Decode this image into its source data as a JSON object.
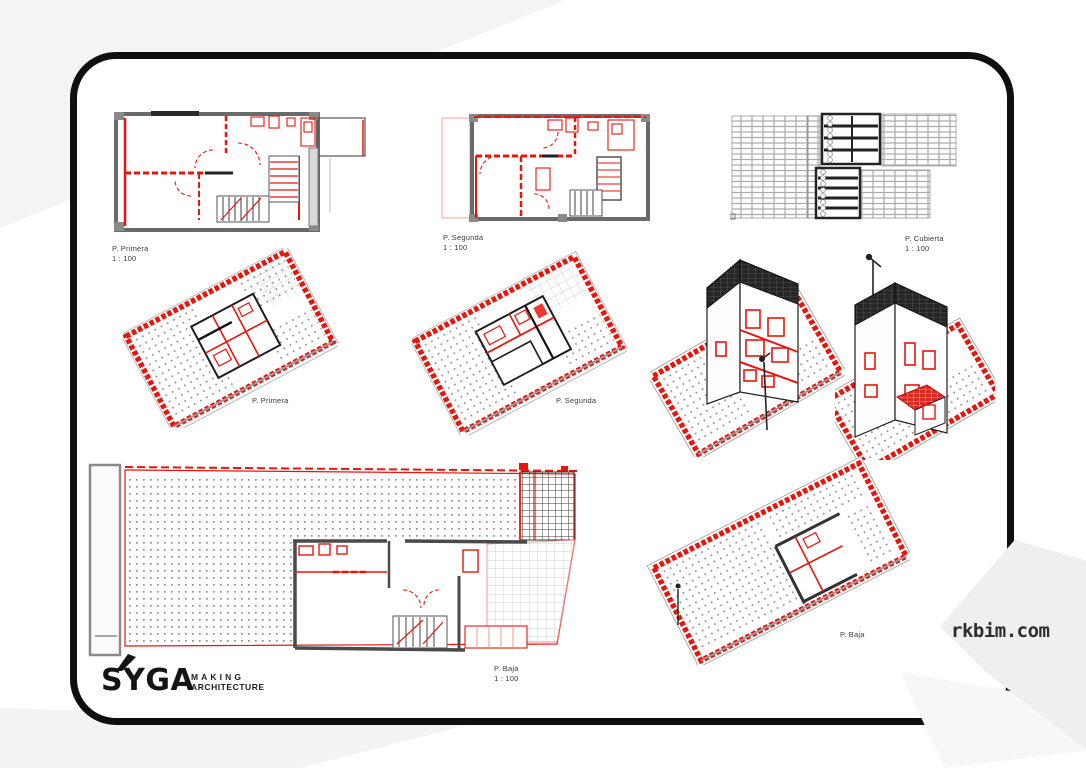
{
  "labels": {
    "plan_primera": {
      "title": "P. Primera",
      "scale": "1 : 100"
    },
    "plan_segunda": {
      "title": "P. Segunda",
      "scale": "1 : 100"
    },
    "plan_cubierta": {
      "title": "P. Cubierta",
      "scale": "1 : 100"
    },
    "axon_primera": {
      "title": "P. Primera"
    },
    "axon_segunda": {
      "title": "P. Segunda"
    },
    "plan_baja": {
      "title": "P. Baja",
      "scale": "1 : 100"
    },
    "axon_baja": {
      "title": "P. Baja"
    }
  },
  "branding": {
    "logo_text": "SYGA",
    "tagline_line1": "MAKING",
    "tagline_line2": "ARCHITECTURE"
  },
  "watermark": {
    "text": "rkbim.com"
  },
  "colors": {
    "accent_red": "#e8150d",
    "wall_gray": "#6a6a6a",
    "ink": "#1a1a1a",
    "paper": "#ffffff",
    "wedge_gray": "#f3f3f4"
  }
}
